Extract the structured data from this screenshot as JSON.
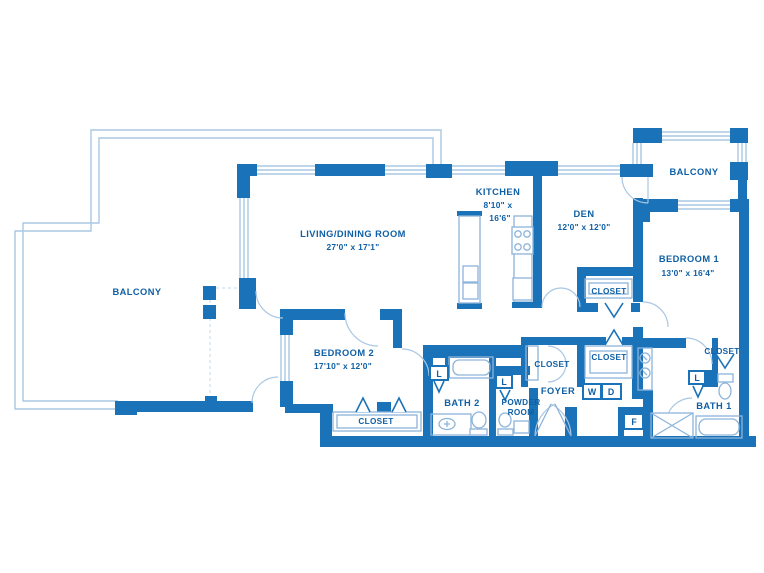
{
  "colors": {
    "wall": "#1a72b8",
    "text": "#0e5fa5",
    "light": "#a9c7e3",
    "fixture": "#8db4da",
    "dash": "#c2d7ea"
  },
  "rooms": {
    "living_dining": {
      "label": "LIVING/DINING ROOM",
      "dims": "27'0\" x 17'1\""
    },
    "kitchen": {
      "label": "KITCHEN",
      "dims1": "8'10\" x",
      "dims2": "16'6\""
    },
    "den": {
      "label": "DEN",
      "dims": "12'0\" x 12'0\""
    },
    "bedroom1": {
      "label": "BEDROOM 1",
      "dims": "13'0\" x 16'4\""
    },
    "bedroom2": {
      "label": "BEDROOM 2",
      "dims": "17'10\" x 12'0\""
    },
    "bath1": {
      "label": "BATH 1"
    },
    "bath2": {
      "label": "BATH 2"
    },
    "powder_room": {
      "label1": "POWDER",
      "label2": "ROOM"
    },
    "foyer": {
      "label": "FOYER"
    },
    "balcony_left": {
      "label": "BALCONY"
    },
    "balcony_right": {
      "label": "BALCONY"
    }
  },
  "closets": {
    "den": "CLOSET",
    "hall": "CLOSET",
    "foyer": "CLOSET",
    "bedroom2": "CLOSET",
    "bedroom1": "CLOSET"
  },
  "fixtures": {
    "washer": "W",
    "dryer": "D",
    "f": "F",
    "linen1": "L",
    "linen2": "L",
    "linen3": "L"
  }
}
